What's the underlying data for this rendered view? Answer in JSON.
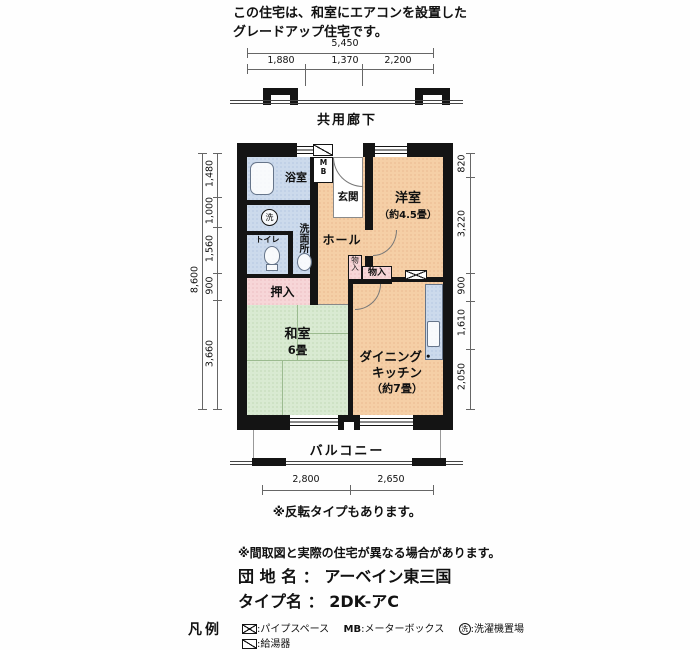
{
  "header": {
    "line1": "この住宅は、和室にエアコンを設置した",
    "line2": "グレードアップ住宅です。"
  },
  "dimensions": {
    "top_total": "5,450",
    "top_segments": [
      "1,880",
      "1,370",
      "2,200"
    ],
    "left_total": "8,600",
    "left_segments": [
      "1,480",
      "1,000",
      "1,560",
      "900",
      "3,660"
    ],
    "right_segments": [
      "820",
      "3,220",
      "900",
      "1,610",
      "2,050"
    ],
    "bottom_segments": [
      "2,800",
      "2,650"
    ]
  },
  "plan": {
    "corridor": "共用廊下",
    "balcony": "バルコニー",
    "rooms": {
      "bath": "浴室",
      "washroom": "洗面所",
      "laundry": "洗",
      "toilet": "トイレ",
      "meter_box": "MB",
      "entrance": "玄関",
      "hall": "ホール",
      "western": "洋室",
      "western_size": "（約4.5畳）",
      "storage_v": "物入",
      "storage_h": "物入",
      "closet": "押入",
      "japanese": "和室",
      "japanese_size": "6畳",
      "dk1": "ダイニング・",
      "dk2": "キッチン",
      "dk_size": "（約7畳）"
    }
  },
  "footer": {
    "reverse_note": "※反転タイプもあります。",
    "disclaimer": "※間取図と実際の住宅が異なる場合があります。",
    "estate_label": "団 地 名",
    "estate_colon": "：",
    "estate_name": "アーベイン東三国",
    "type_label": "タイプ名",
    "type_colon": "：",
    "type_value": "2DK-アC",
    "legend_title": "凡例",
    "legend_pipe": ":パイプスペース",
    "legend_mb_key": "MB",
    "legend_mb": ":メーターボックス",
    "legend_wash_key": "洗",
    "legend_wash": ":洗濯機置場",
    "legend_boiler": ":給湯器"
  }
}
